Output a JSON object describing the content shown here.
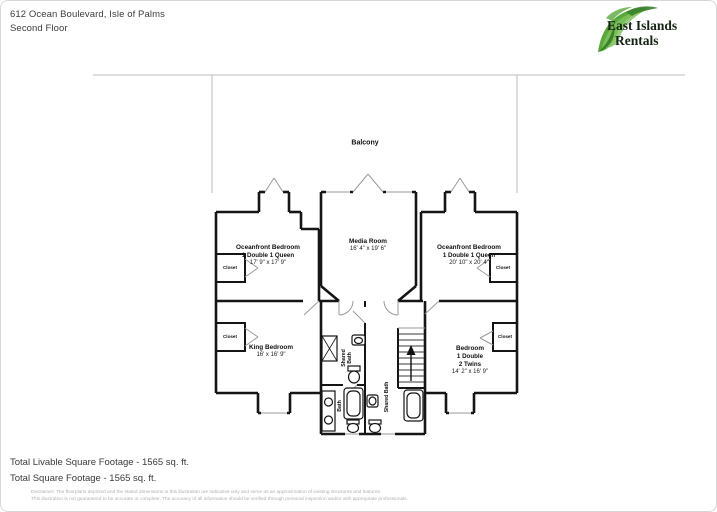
{
  "header": {
    "address_line1": "612 Ocean Boulevard, Isle of Palms",
    "address_line2": "Second Floor"
  },
  "logo": {
    "line1": "East Islands",
    "line2": "Rentals",
    "leaf_color": "#5aa73c",
    "leaf_dark": "#39822a",
    "leaf_light": "#7fc25e",
    "text_color": "#152313"
  },
  "plan": {
    "balcony_label": "Balcony",
    "closet_label": "Closet",
    "rooms": {
      "oceanfront_left": {
        "name": "Oceanfront Bedroom",
        "beds": "1 Double 1 Queen",
        "dims": "17' 9\" x 17' 9\""
      },
      "media": {
        "name": "Media Room",
        "dims": "16' 4\" x 19' 6\""
      },
      "oceanfront_right": {
        "name": "Oceanfront Bedroom",
        "beds": "1 Double 1 Queen",
        "dims": "20' 10\" x 20' 4\""
      },
      "king": {
        "name": "King Bedroom",
        "dims": "16' x 16' 9\""
      },
      "bedroom": {
        "name": "Bedroom",
        "beds_line1": "1 Double",
        "beds_line2": "2 Twins",
        "dims": "14' 2\" x 16' 9\""
      },
      "shared_bath_top": {
        "line1": "Shared",
        "line2": "Bath"
      },
      "bath": {
        "name": "Bath"
      },
      "shared_bath_right": {
        "name": "Shared Bath"
      }
    }
  },
  "footer": {
    "line1": "Total Livable Square Footage - 1565 sq. ft.",
    "line2": "Total Square Footage - 1565 sq. ft.",
    "disclaimer_line1": "Disclaimer: The floorplans depicted and the stated dimensions in this illustration are indicative only and serve as an approximation of existing structures and features.",
    "disclaimer_line2": "This illustration is not guaranteed to be accurate or complete. The accuracy of all information should be verified through personal inspection and/or with appropriate professionals."
  }
}
